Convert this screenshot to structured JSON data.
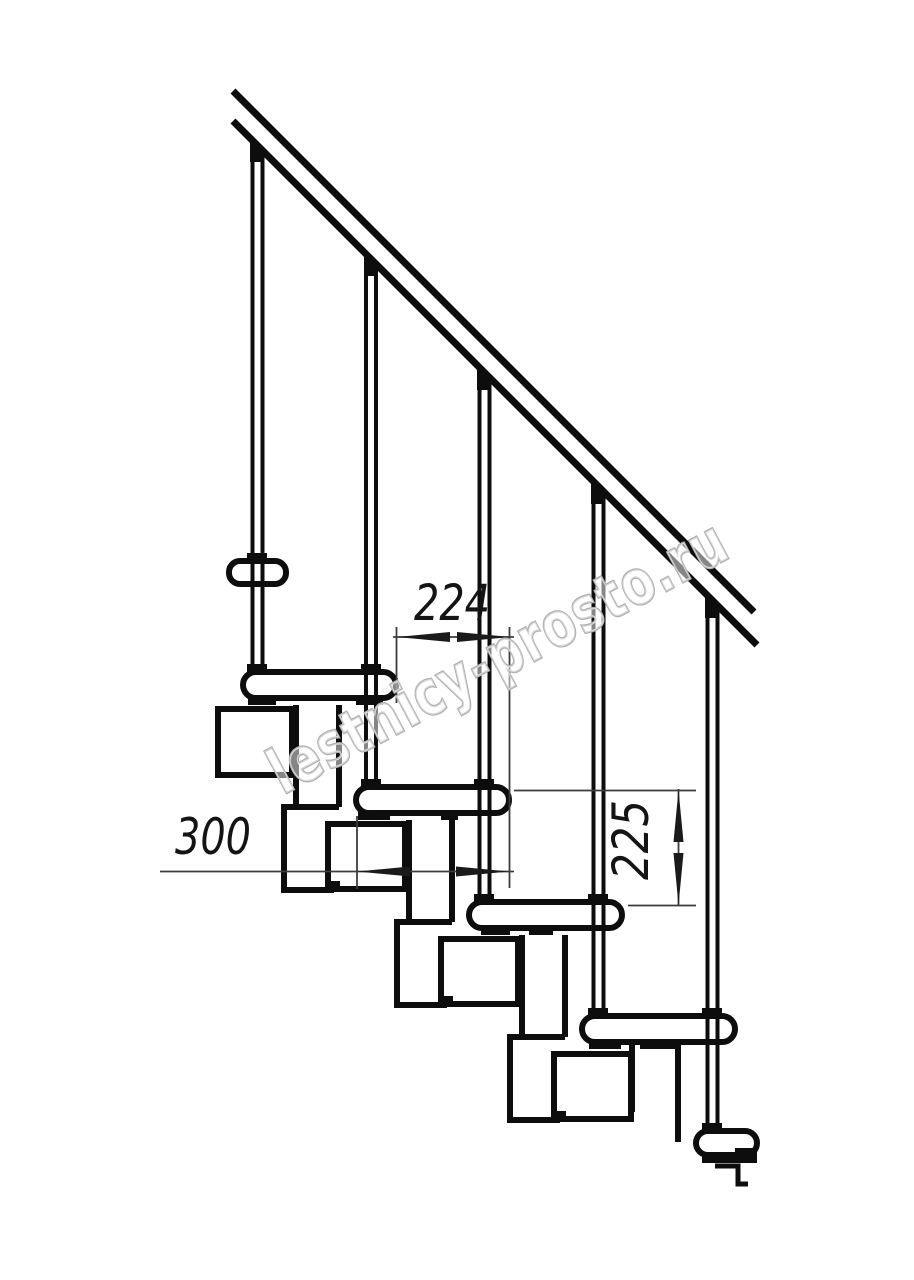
{
  "page": {
    "description": "Side-view technical drawing of a modular staircase with handrail, balusters, treads and support modules"
  },
  "colors": {
    "background": "#ffffff",
    "drawing_line": "#0d0d0d",
    "dimension_line": "#3c3c3c",
    "dimension_text": "#141414",
    "watermark_outline": "#b0b0b0"
  },
  "dimensions": {
    "step_run": {
      "value": "224"
    },
    "tread_depth": {
      "value": "300"
    },
    "step_rise": {
      "value": "225"
    }
  },
  "watermark": {
    "text": "lestnicy-prosto.ru"
  }
}
